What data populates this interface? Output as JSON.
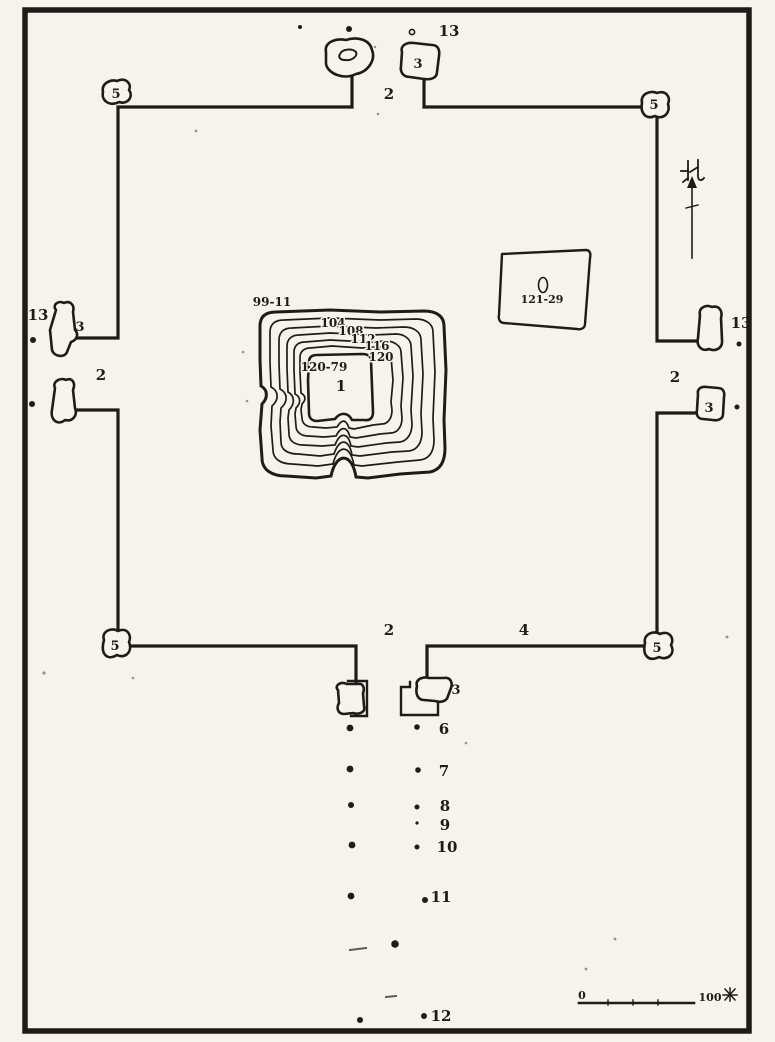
{
  "figure": {
    "type": "scanned archaeological site plan with walled enclosure, central stepped mound, gates and survey points",
    "north_label": "北",
    "scale": {
      "start": "0",
      "end_value": "100",
      "end_unit": "米",
      "full_end_label": "100米"
    }
  },
  "colors": {
    "ink": "#201b16",
    "paper": "#f5f3ec"
  },
  "mound": {
    "number": "1",
    "base_elevation": "99-11",
    "summit_elevation": "120-79",
    "contours": [
      "104",
      "108",
      "112",
      "116",
      "120"
    ]
  },
  "platform_elevation": "121-29",
  "labels": {
    "n13_north": "13",
    "n3_north_gate": "3",
    "n2_north_gate": "2",
    "n5_nw": "5",
    "n5_ne": "5",
    "n13_west": "13",
    "n3_west_gate": "3",
    "n2_west_gate": "2",
    "n13_east": "13",
    "n2_east_gate": "2",
    "n3_east_gate": "3",
    "n5_sw": "5",
    "n2_south_gate": "2",
    "n4_south_wall": "4",
    "n5_se": "5",
    "n3_south_gate": "3",
    "n6": "6",
    "n7": "7",
    "n8": "8",
    "n9": "9",
    "n10": "10",
    "n11": "11",
    "n12": "12"
  }
}
